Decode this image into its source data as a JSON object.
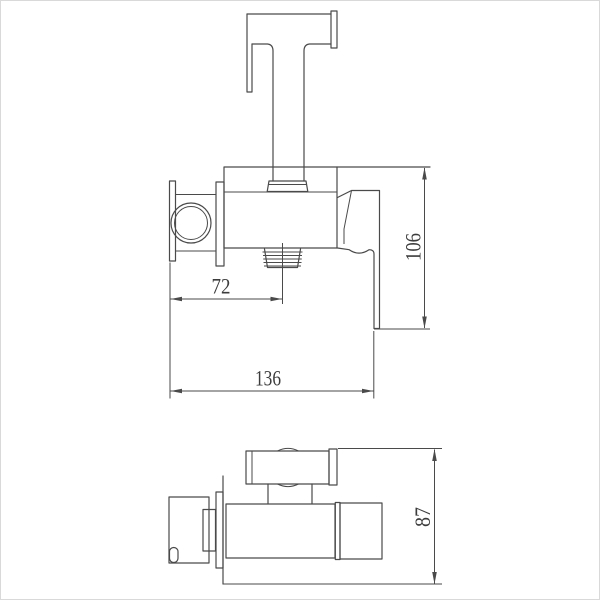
{
  "canvas": {
    "background": "#ffffff",
    "frame_color": "#d9d9d9",
    "line_color": "#4a4a4a",
    "text_color": "#3c3c3c"
  },
  "dimensions": {
    "d72": "72",
    "d136": "136",
    "d106": "106",
    "d87": "87"
  }
}
